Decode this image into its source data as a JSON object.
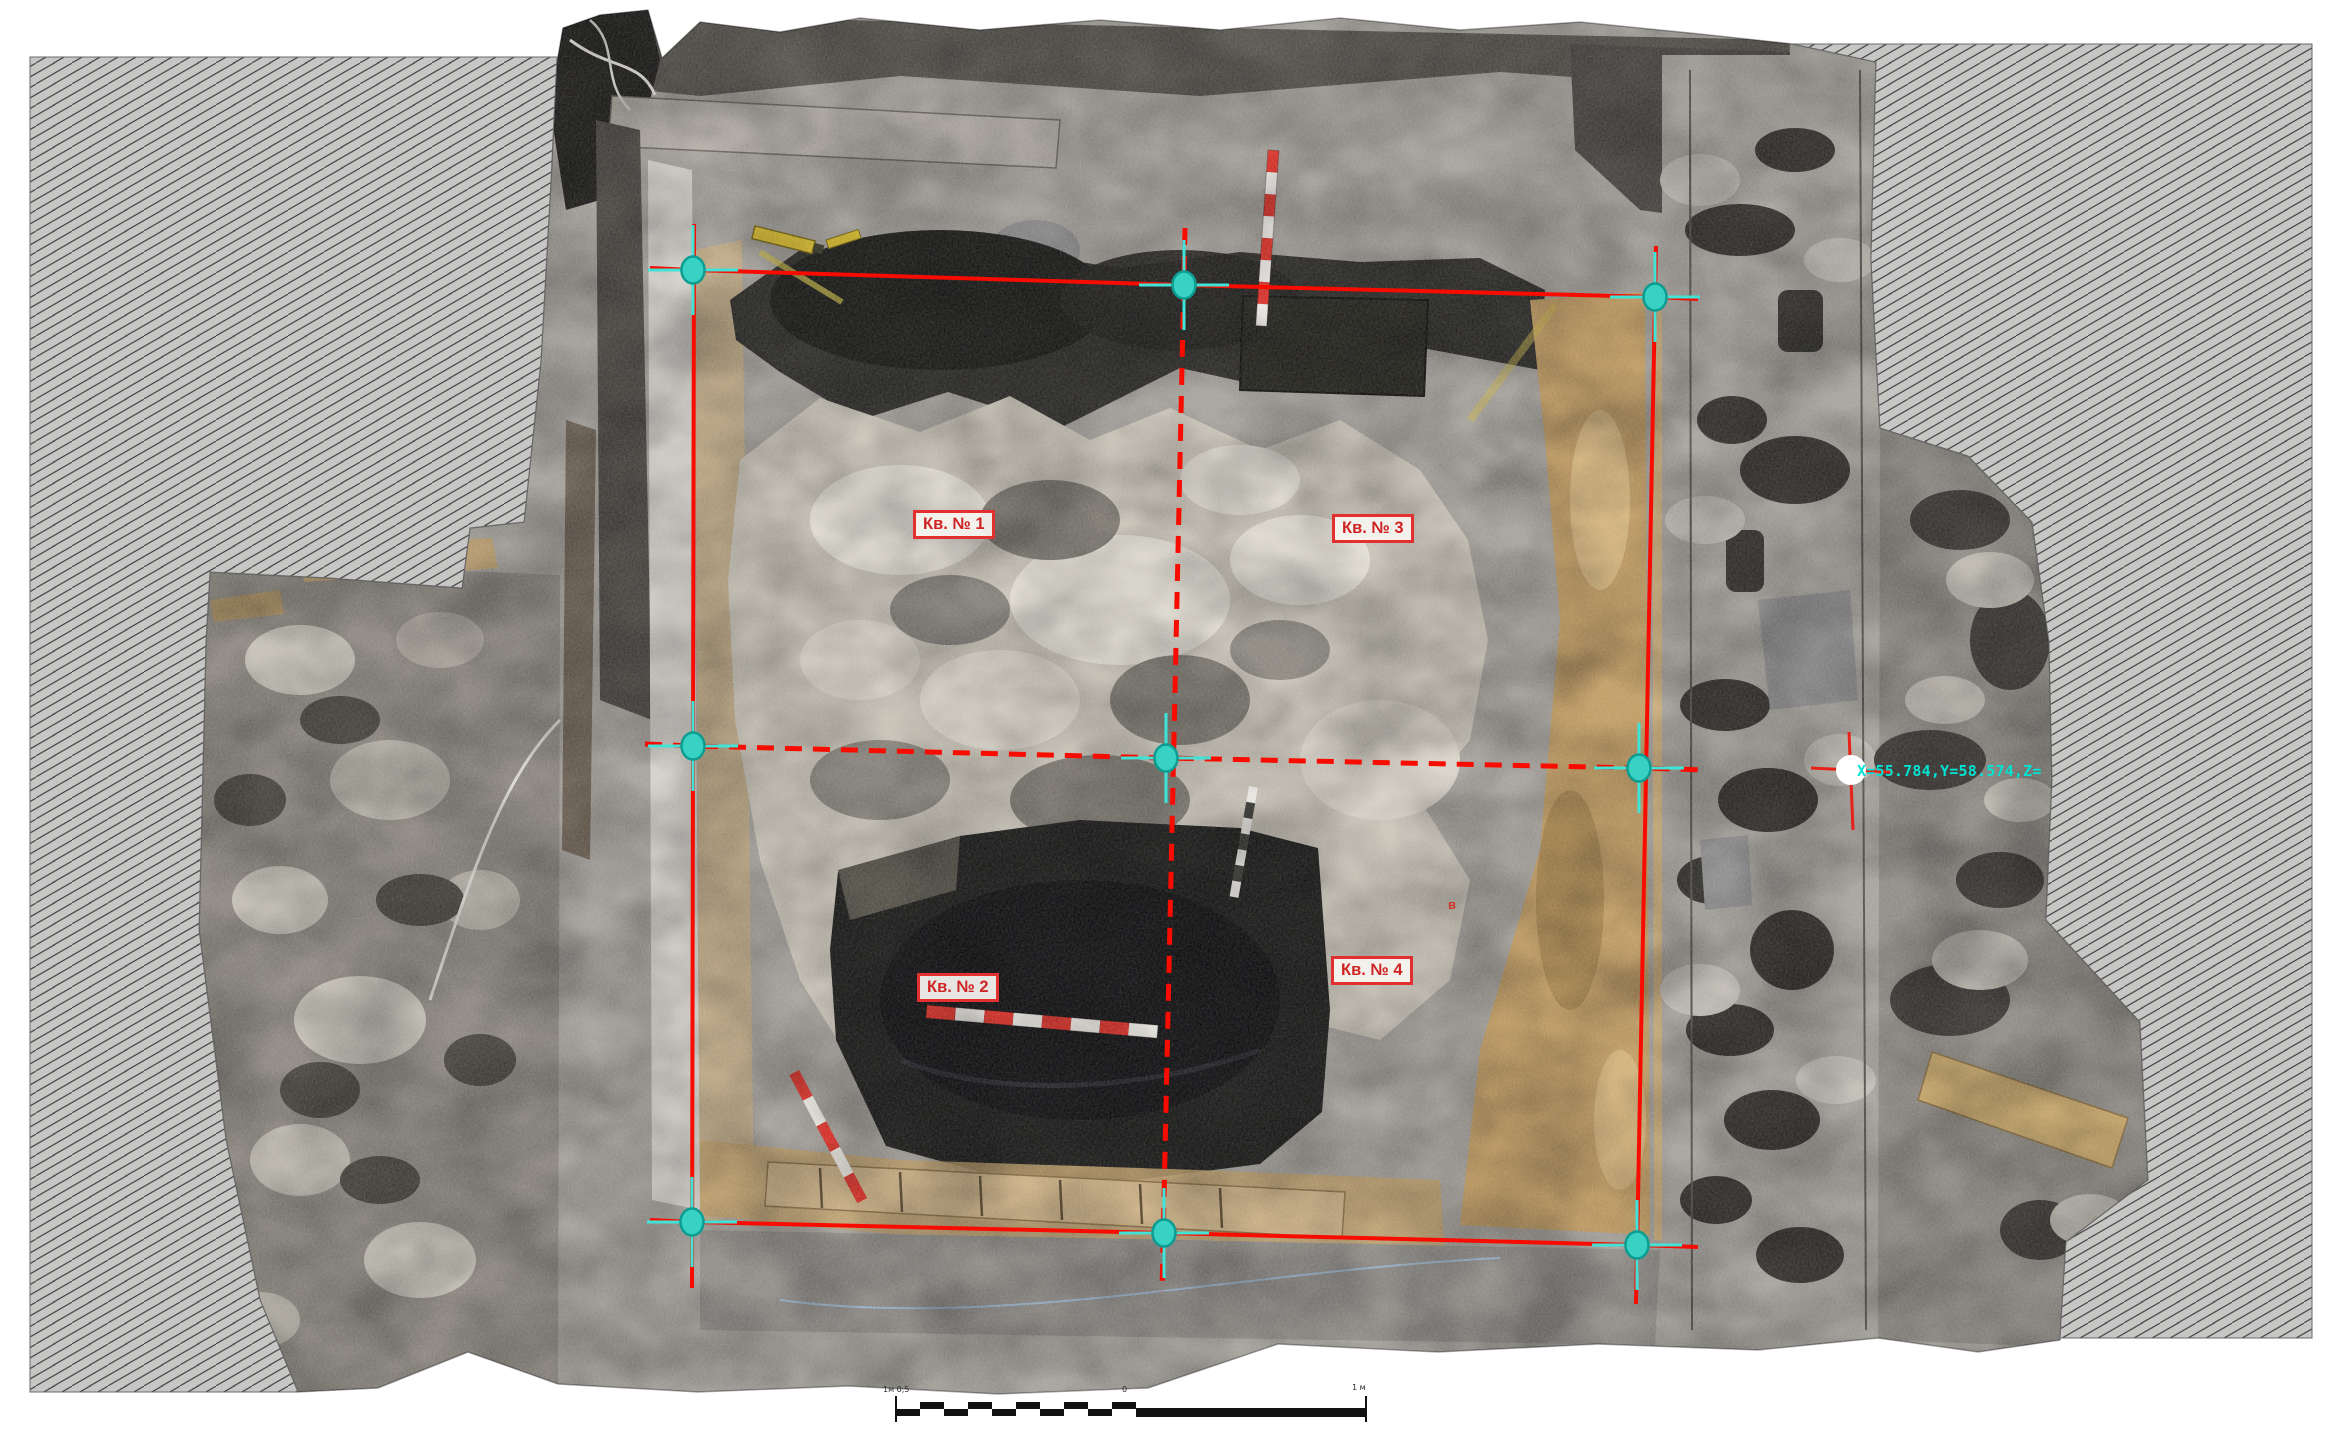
{
  "plan": {
    "type": "archaeological excavation orthophoto plan",
    "quadrant_labels": [
      {
        "id": 1,
        "text": "Кв. № 1"
      },
      {
        "id": 2,
        "text": "Кв. № 2"
      },
      {
        "id": 3,
        "text": "Кв. № 3"
      },
      {
        "id": 4,
        "text": "Кв. № 4"
      }
    ],
    "coordinate_readout": "X=55.784,Y=58.574,Z=",
    "point_mark": "в",
    "scale_bar": {
      "left_label": "1м 0,5",
      "zero_label": "0",
      "right_label": "1 м"
    },
    "survey_grid": {
      "rows": 3,
      "columns": 3,
      "marker_icon": "survey-point-marker",
      "edge_marker_icon": "edge-survey-marker"
    },
    "colors": {
      "grid_red": "#f80c00",
      "marker_cyan": "#37d2c4",
      "marker_cross_cyan": "#3fe4d7",
      "coordinate_teal": "#00e2d2",
      "label_red": "#cf2424",
      "hatch_gray": "#c6c6c5",
      "hatch_line": "#4a4a4a"
    }
  }
}
